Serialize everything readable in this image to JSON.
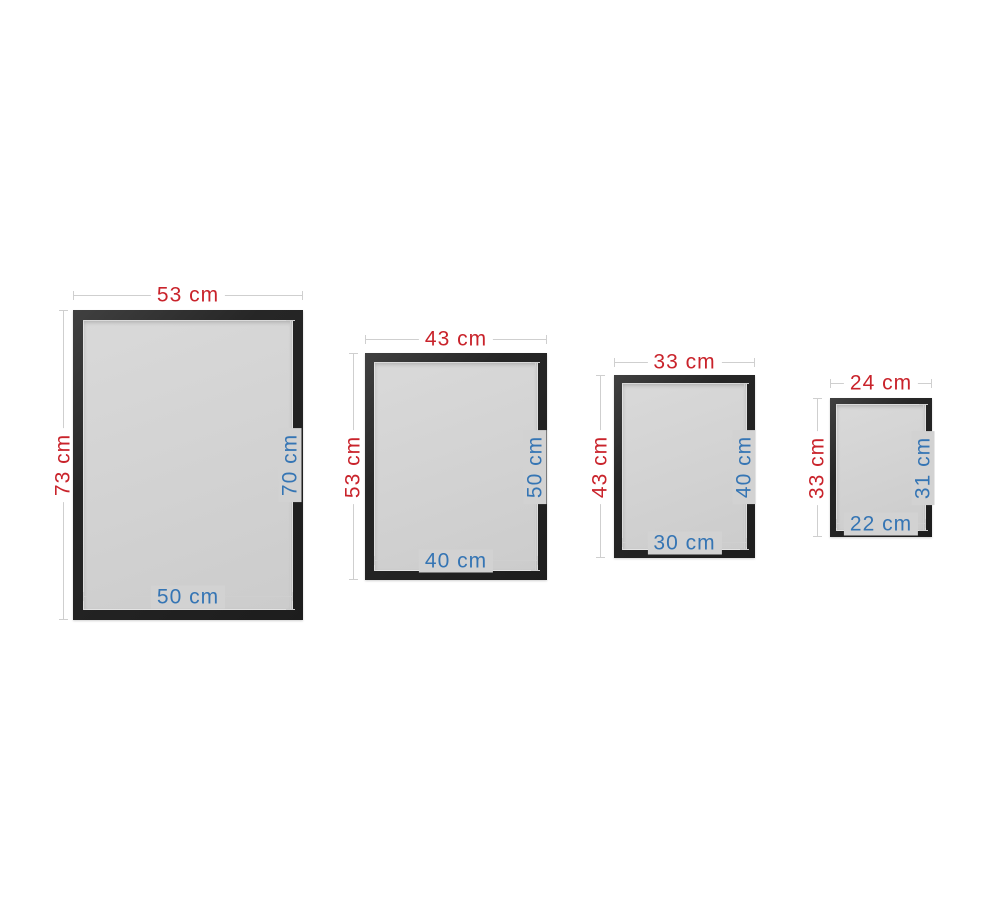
{
  "unit": "cm",
  "colors": {
    "background": "#ffffff",
    "outer_dimension_text": "#c9232b",
    "inner_dimension_text": "#3575b4",
    "dimension_line": "#cfcfcf",
    "frame": "#2a2a2a",
    "mat": "#d2d2d2"
  },
  "frames": [
    {
      "outer_width": "53 cm",
      "outer_height": "73 cm",
      "inner_height": "70 cm",
      "inner_width": "50 cm"
    },
    {
      "outer_width": "43 cm",
      "outer_height": "53 cm",
      "inner_height": "50 cm",
      "inner_width": "40 cm"
    },
    {
      "outer_width": "33 cm",
      "outer_height": "43 cm",
      "inner_height": "40 cm",
      "inner_width": "30 cm"
    },
    {
      "outer_width": "24 cm",
      "outer_height": "33 cm",
      "inner_height": "31 cm",
      "inner_width": "22 cm"
    }
  ]
}
